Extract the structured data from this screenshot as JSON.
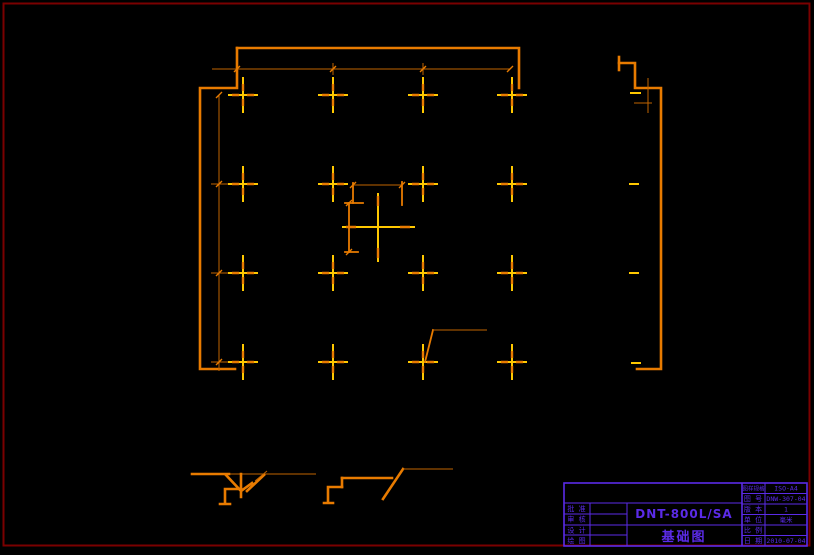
{
  "drawing": {
    "type": "foundation-plan",
    "model_number": "DNT-800L/SA",
    "main_title": "基础图"
  },
  "title_block": {
    "model_number": "DNT-800L/SA",
    "main_title": "基础图",
    "left_rows": [
      {
        "label": "批 准",
        "value": ""
      },
      {
        "label": "审 核",
        "value": ""
      },
      {
        "label": "设 计",
        "value": ""
      },
      {
        "label": "绘 图",
        "value": ""
      }
    ],
    "right_rows": [
      {
        "label": "图样规格",
        "value": "ISO-A4"
      },
      {
        "label": "图 号",
        "value": "DNW-307-04"
      },
      {
        "label": "版 本",
        "value": "1"
      },
      {
        "label": "单 位",
        "value": "毫米"
      },
      {
        "label": "比 例",
        "value": ""
      },
      {
        "label": "日 期",
        "value": "2010-07-04"
      }
    ]
  },
  "colors": {
    "background": "#000000",
    "page_frame": "#7a0000",
    "line_thick": "#e87b00",
    "line_thin": "#c06400",
    "marker_yellow": "#ffc800",
    "title_block": "#5b2be8"
  }
}
